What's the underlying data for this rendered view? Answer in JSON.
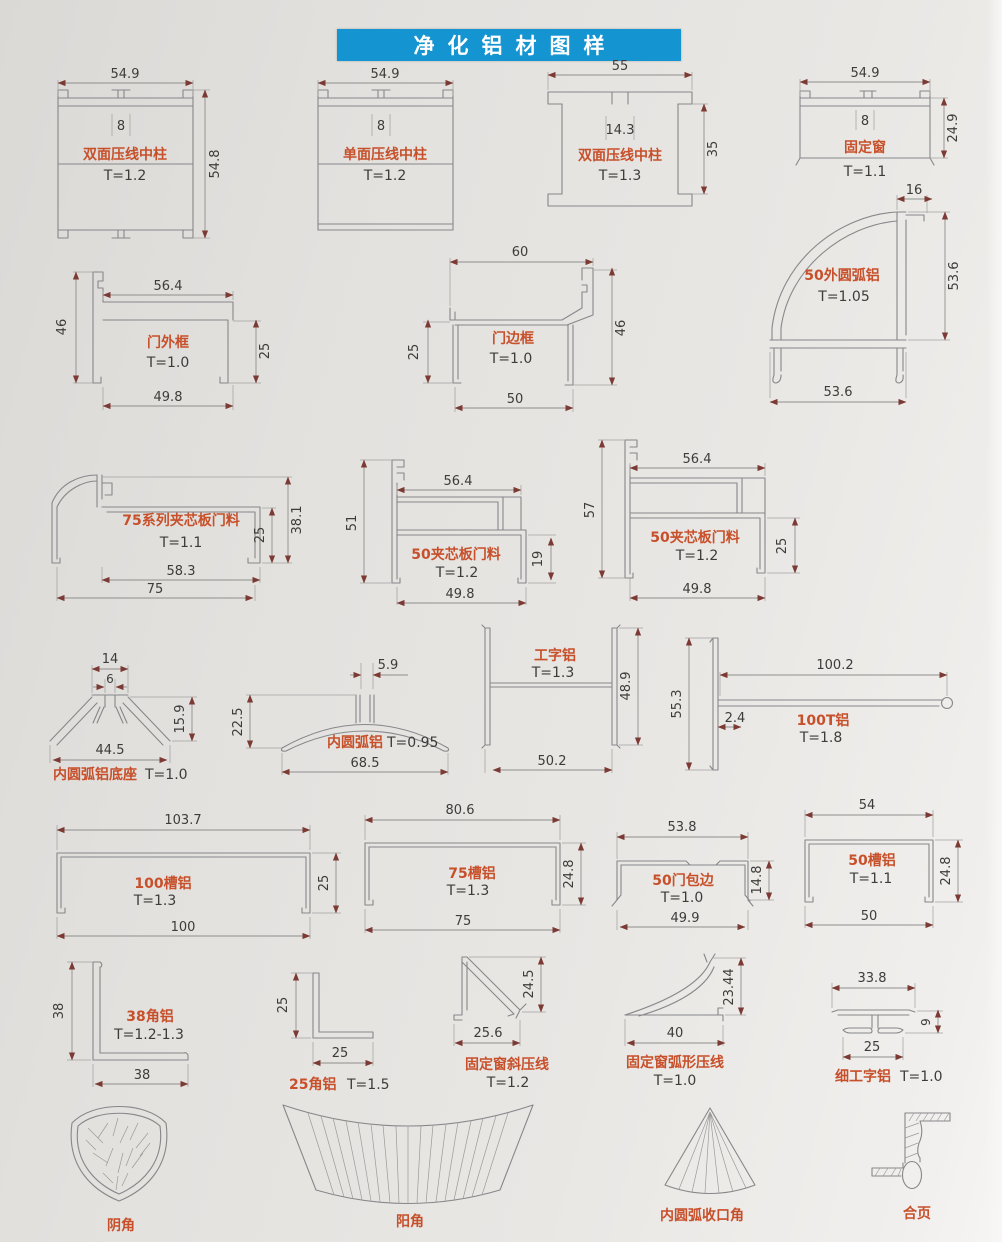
{
  "page": {
    "title": "净化铝材图样"
  },
  "colors": {
    "banner_blue": "#1494d0",
    "label_red": "#c7502b",
    "dim_text": "#3c3c3a",
    "line_gray": "#87878a",
    "arrow_red": "#7c3a34",
    "paper": "#e6e4e1"
  },
  "profiles": {
    "p1": {
      "name": "双面压线中柱",
      "t": "T=1.2",
      "width": "54.9",
      "slot": "8",
      "height": "54.8"
    },
    "p2": {
      "name": "单面压线中柱",
      "t": "T=1.2",
      "width": "54.9",
      "slot": "8"
    },
    "p3": {
      "name": "双面压线中柱",
      "t": "T=1.3",
      "width": "55",
      "slot": "14.3",
      "height": "35"
    },
    "p4": {
      "name": "固定窗",
      "t": "T=1.1",
      "width": "54.9",
      "slot": "8",
      "height": "24.9"
    },
    "p5": {
      "name": "门外框",
      "t": "T=1.0",
      "left": "46",
      "top": "56.4",
      "right": "25",
      "bottom": "49.8"
    },
    "p6": {
      "name": "门边框",
      "t": "T=1.0",
      "top": "60",
      "left": "25",
      "right": "46",
      "bottom": "50"
    },
    "p7": {
      "name": "50外圆弧铝",
      "t": "T=1.05",
      "top": "16",
      "right": "53.6",
      "bottom": "53.6"
    },
    "p8": {
      "name": "75系列夹芯板门料",
      "t": "T=1.1",
      "right_outer": "38.1",
      "right_inner": "25",
      "bottom_inner": "58.3",
      "bottom": "75"
    },
    "p9": {
      "name": "50夹芯板门料",
      "t": "T=1.2",
      "left": "51",
      "top": "56.4",
      "right": "19",
      "bottom": "49.8"
    },
    "p10": {
      "name": "50夹芯板门料",
      "t": "T=1.2",
      "left": "57",
      "top": "56.4",
      "right": "25",
      "bottom": "49.8"
    },
    "p11": {
      "name": "内圆弧铝底座",
      "t": "T=1.0",
      "top": "14",
      "slot": "6",
      "right": "15.9",
      "bottom": "44.5"
    },
    "p12": {
      "name": "内圆弧铝",
      "t": "T=0.95",
      "top": "5.9",
      "left": "22.5",
      "bottom": "68.5"
    },
    "p13": {
      "name": "工字铝",
      "t": "T=1.3",
      "right": "48.9",
      "bottom": "50.2"
    },
    "p14": {
      "name": "100T铝",
      "t": "T=1.8",
      "left": "55.3",
      "top": "100.2",
      "offset": "2.4"
    },
    "p15": {
      "name": "100槽铝",
      "t": "T=1.3",
      "top": "103.7",
      "right": "25",
      "bottom": "100"
    },
    "p16": {
      "name": "75槽铝",
      "t": "T=1.3",
      "top": "80.6",
      "right": "24.8",
      "bottom": "75"
    },
    "p17": {
      "name": "50门包边",
      "t": "T=1.0",
      "top": "53.8",
      "right": "14.8",
      "bottom": "49.9"
    },
    "p18": {
      "name": "50槽铝",
      "t": "T=1.1",
      "top": "54",
      "right": "24.8",
      "bottom": "50"
    },
    "p19": {
      "name": "38角铝",
      "t": "T=1.2-1.3",
      "left": "38",
      "bottom": "38"
    },
    "p20": {
      "name": "25角铝",
      "t": "T=1.5",
      "left": "25",
      "bottom": "25"
    },
    "p21": {
      "name": "固定窗斜压线",
      "t": "T=1.2",
      "right": "24.5",
      "bottom": "25.6"
    },
    "p22": {
      "name": "固定窗弧形压线",
      "t": "T=1.0",
      "right": "23.44",
      "bottom": "40"
    },
    "p23": {
      "name": "细工字铝",
      "t": "T=1.0",
      "top": "33.8",
      "right": "9",
      "bottom": "25"
    },
    "p24": {
      "name": "阴角"
    },
    "p25": {
      "name": "阳角"
    },
    "p26": {
      "name": "内圆弧收口角"
    },
    "p27": {
      "name": "合页"
    }
  }
}
